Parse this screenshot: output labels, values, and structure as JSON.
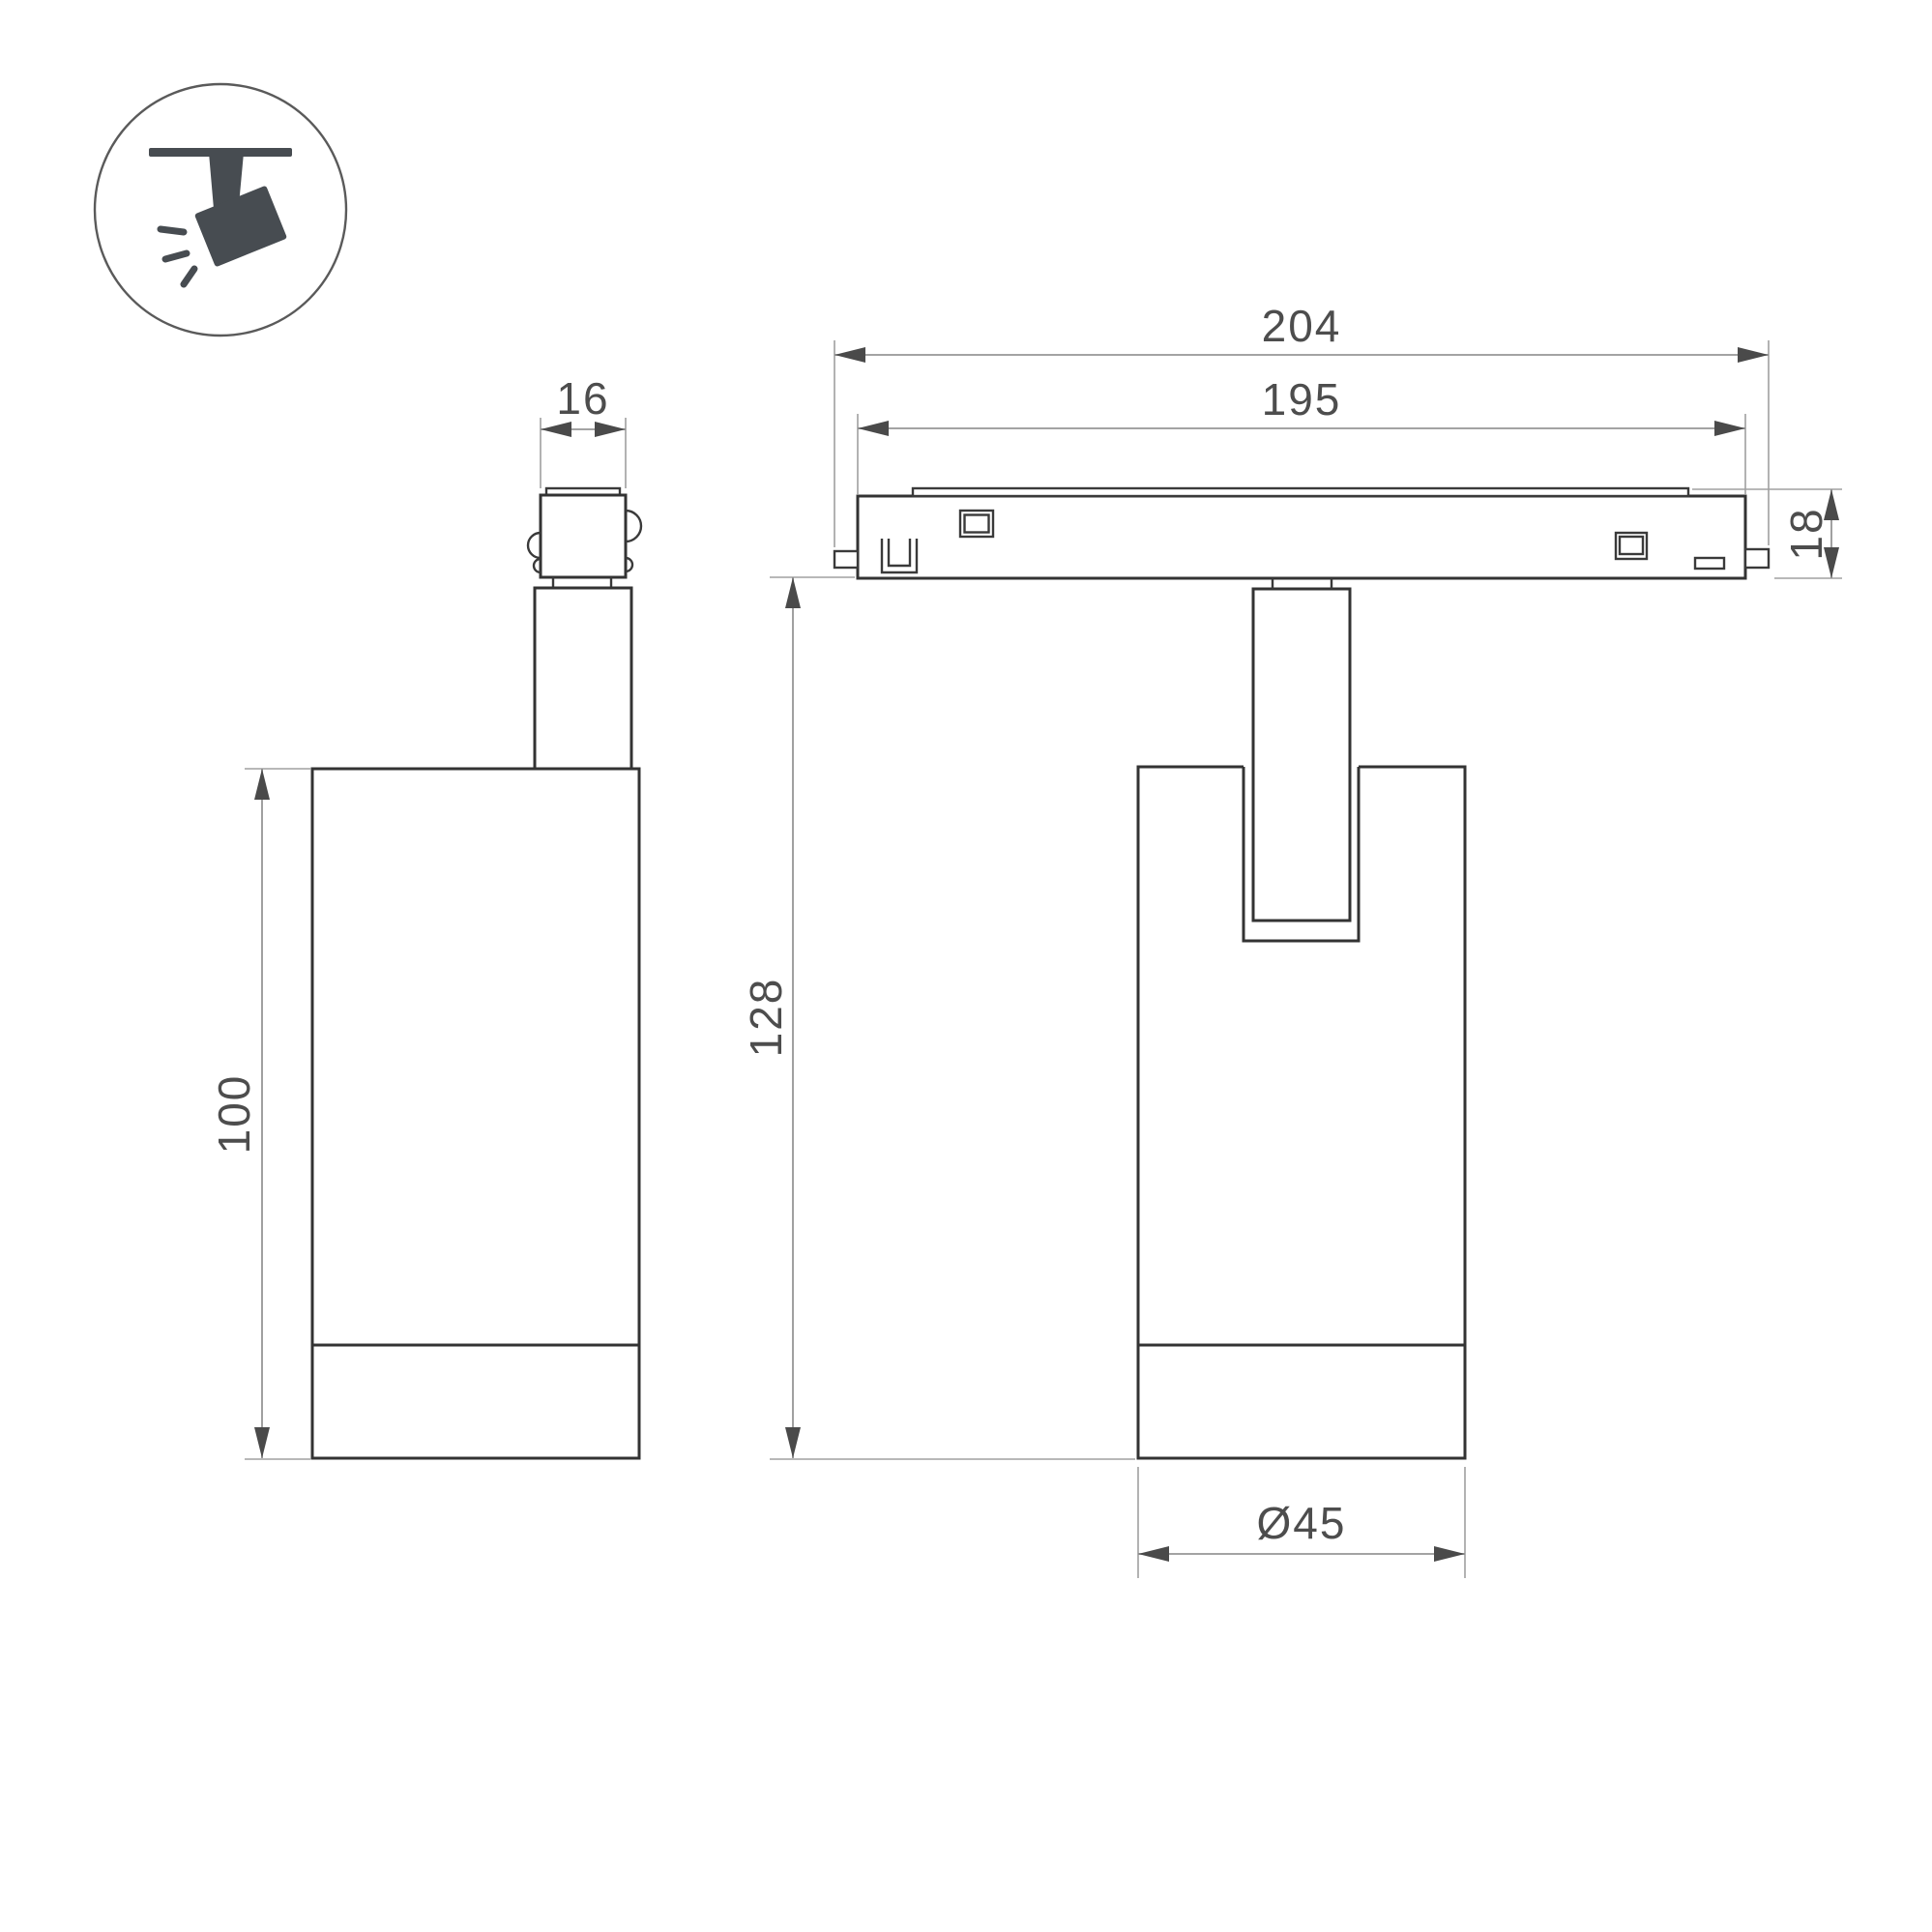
{
  "icon": {
    "name": "track-spotlight-icon"
  },
  "dimensions": {
    "adapter_width": "16",
    "body_height": "100",
    "track_outer_length": "204",
    "track_inner_length": "195",
    "track_height": "18",
    "overall_height": "128",
    "body_diameter": "Ø45"
  },
  "colors": {
    "outline": "#333333",
    "dimension_line": "#969696",
    "arrowhead": "#4a4a4a",
    "dimension_text": "#4d4d4d",
    "icon_glyph": "#474c51",
    "background": "#ffffff"
  }
}
